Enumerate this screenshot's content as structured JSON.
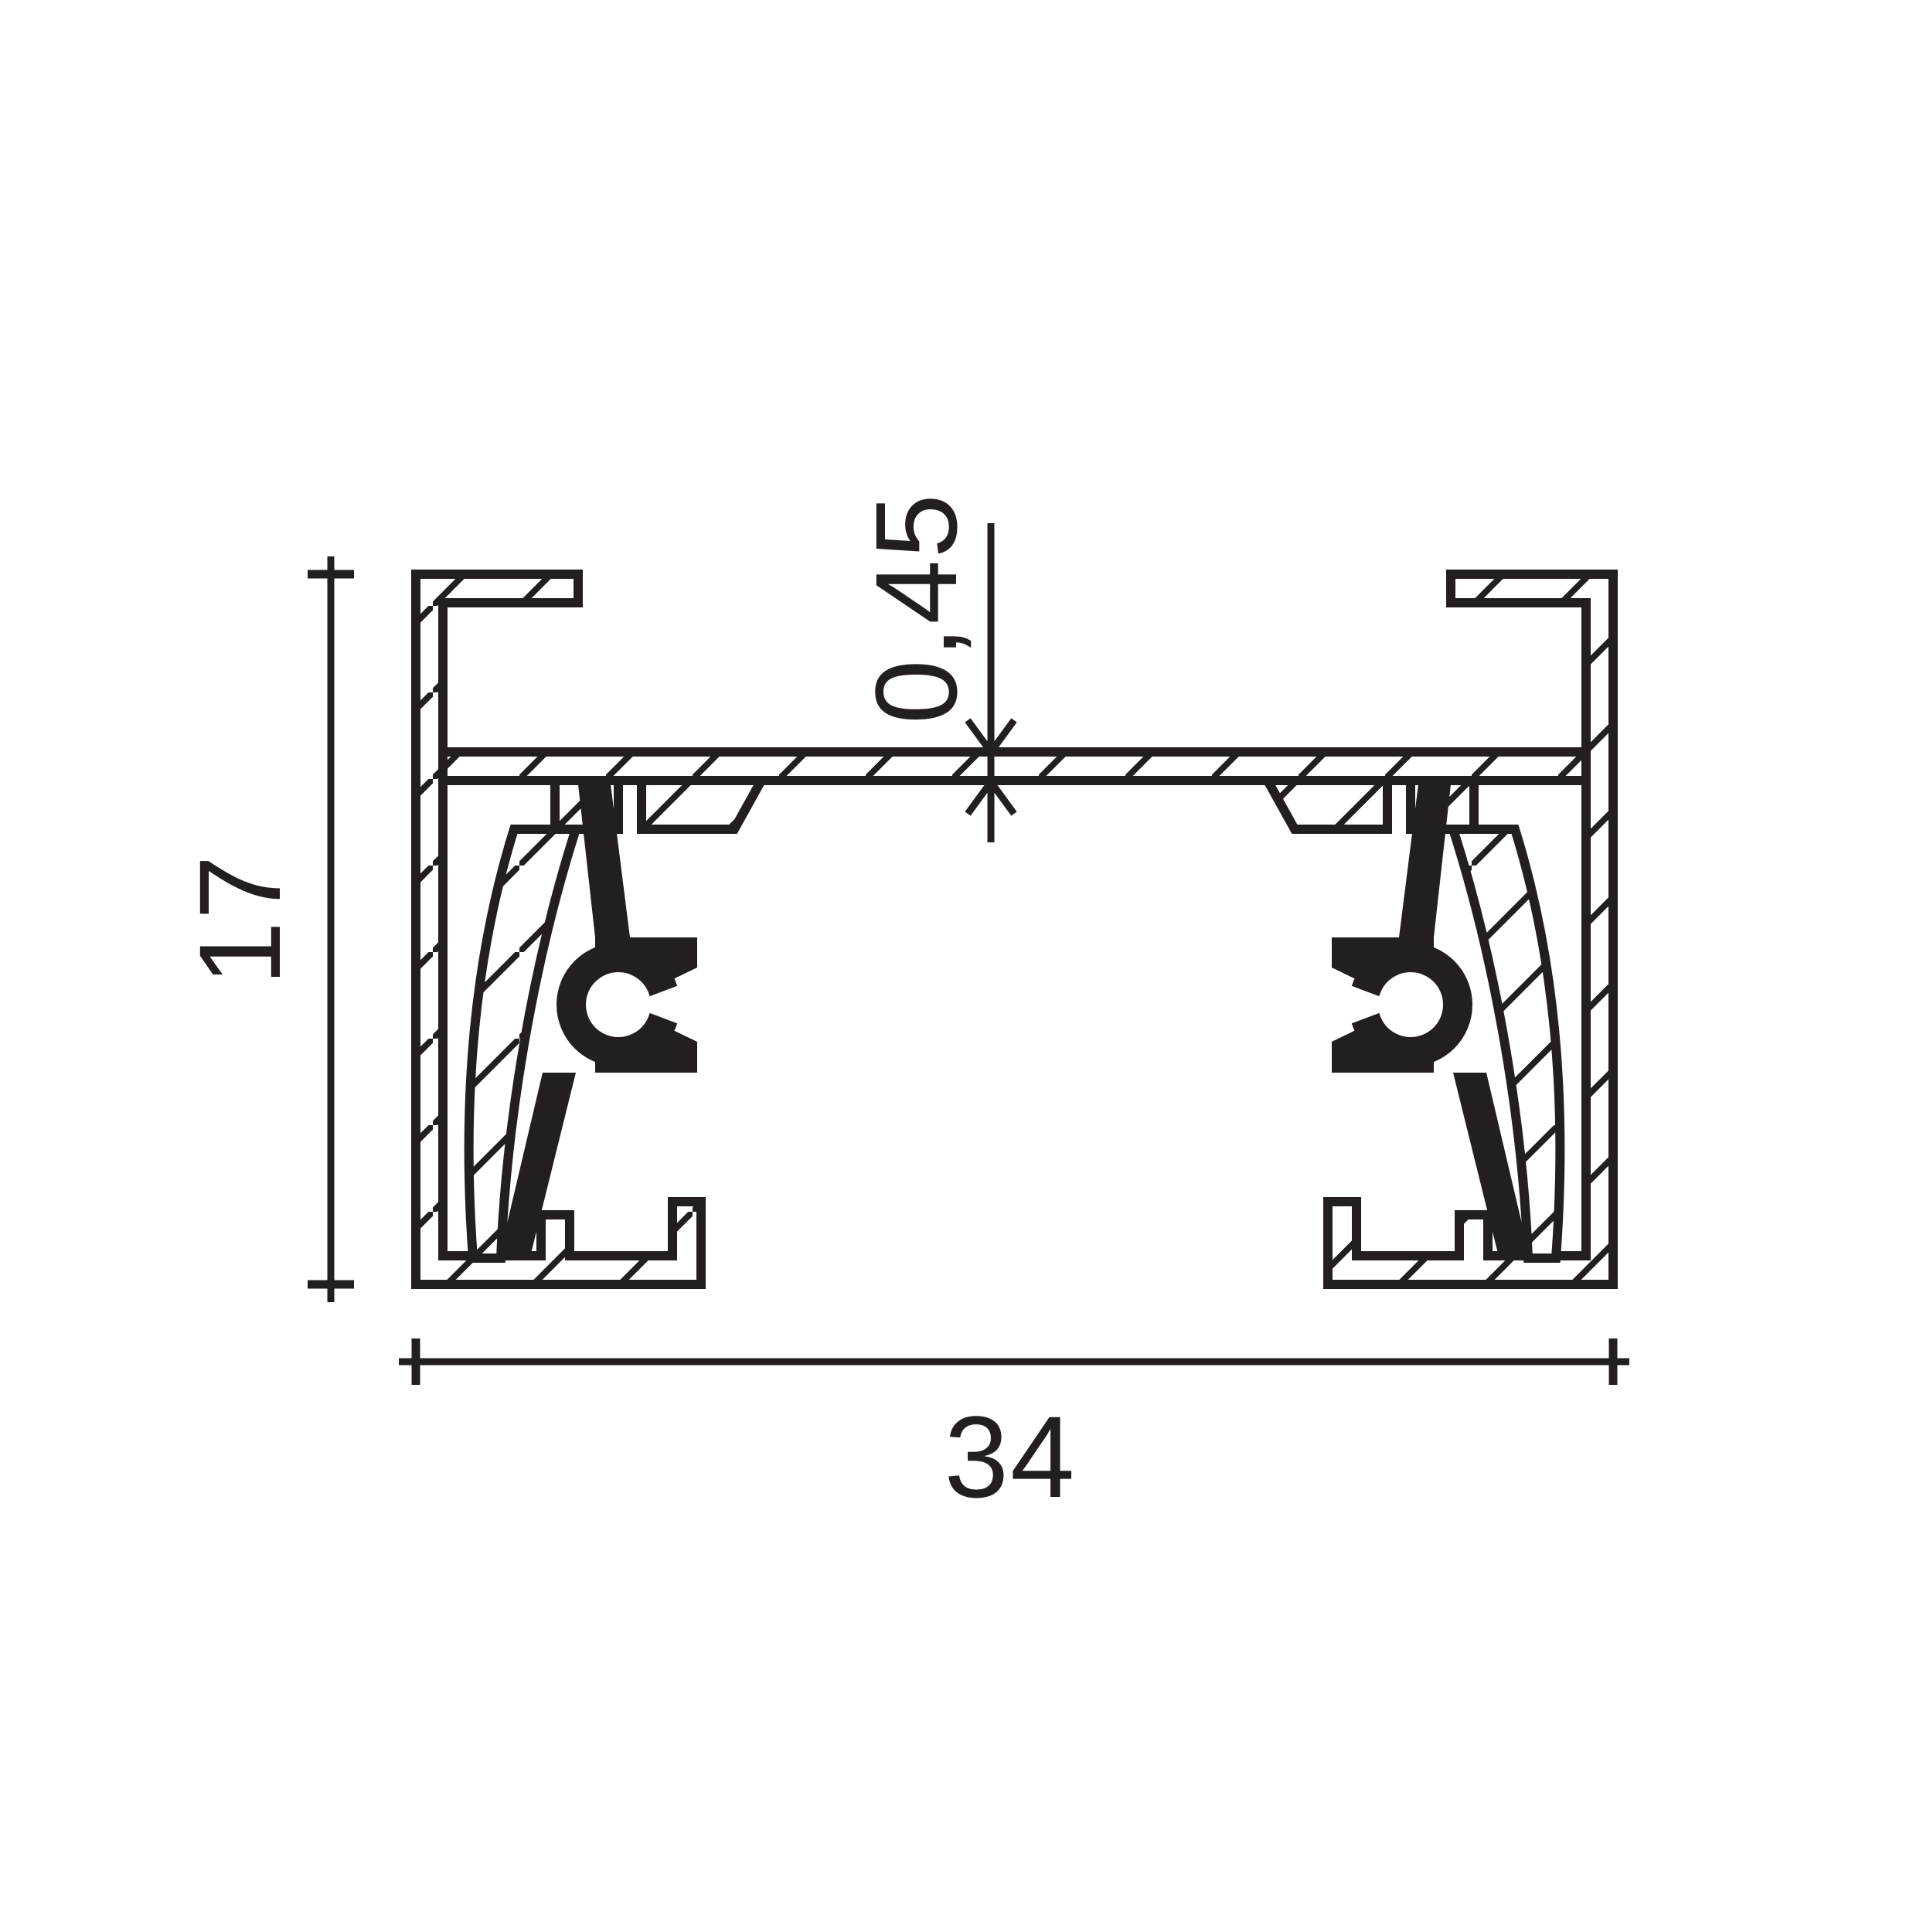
{
  "drawing": {
    "kind": "profile-cross-section",
    "description": "Aluminium track profile cross-section with insulator and conductor inserts",
    "colors": {
      "ink": "#231f20",
      "background": "#ffffff"
    }
  },
  "dimensions": {
    "width_label": "34",
    "height_label": "17",
    "web_thickness_label": "0,45"
  }
}
